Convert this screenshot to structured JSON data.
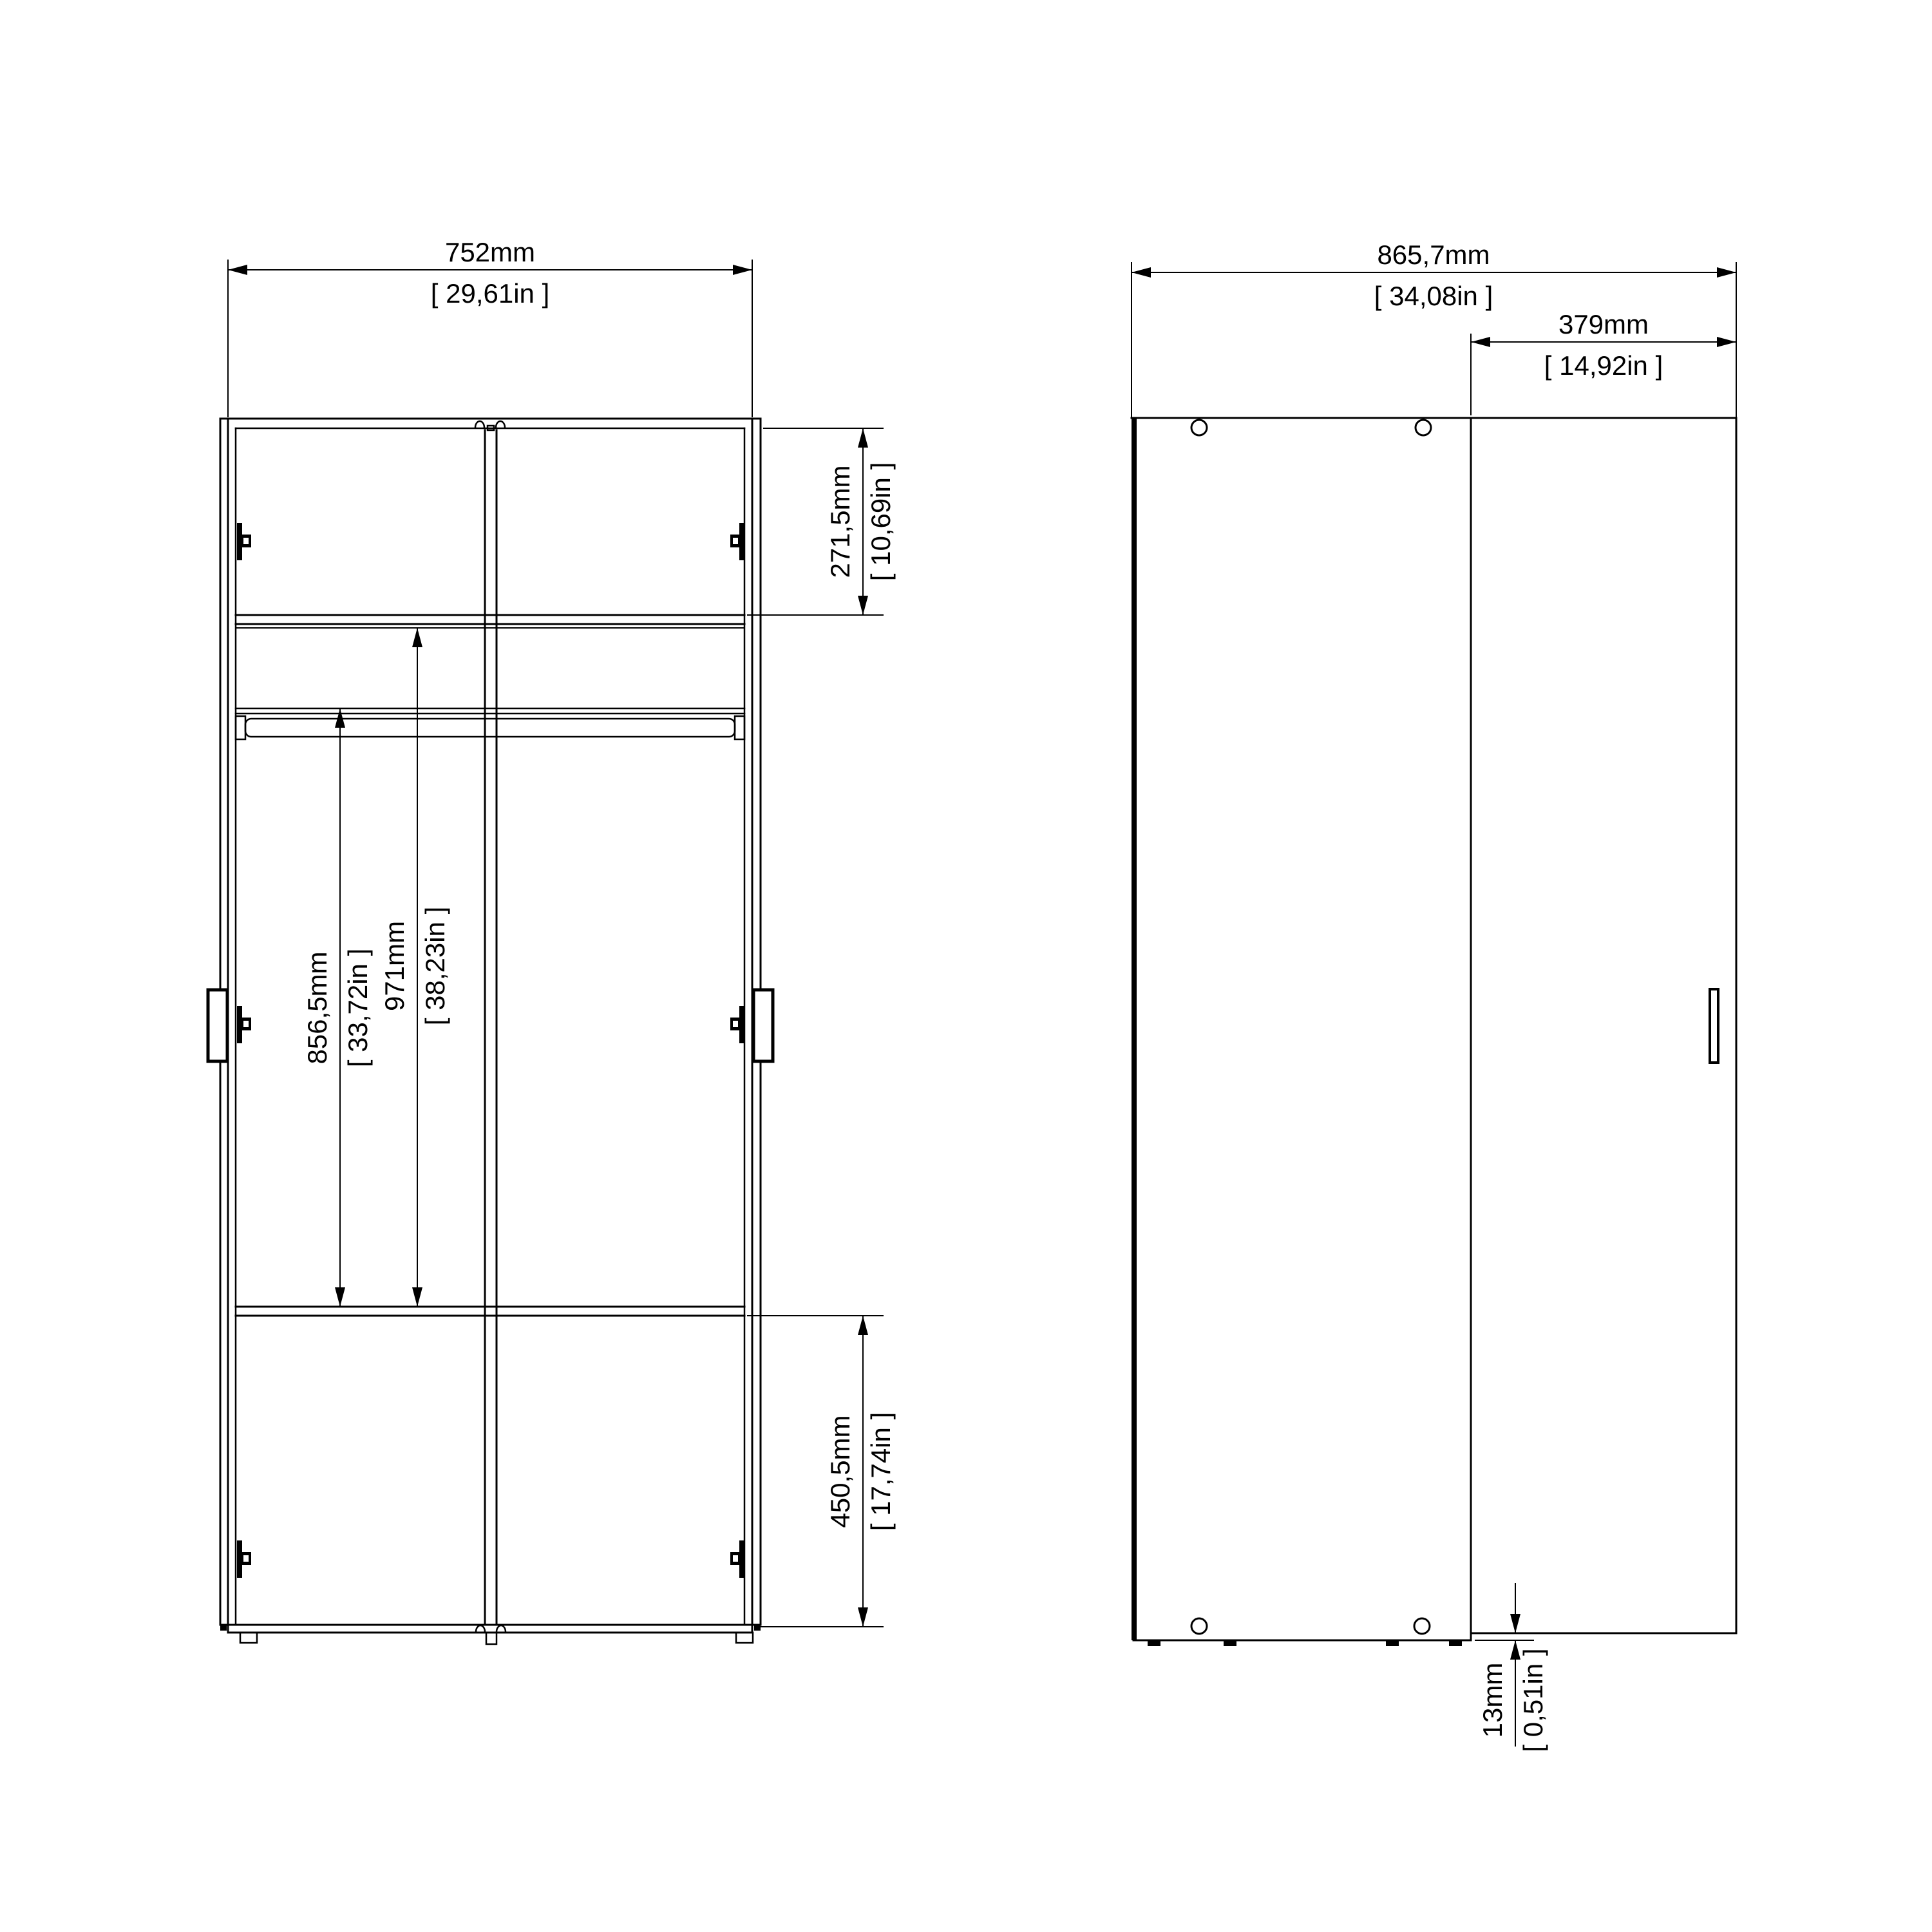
{
  "colors": {
    "line": "#000000",
    "background": "#ffffff"
  },
  "dims": {
    "front_width": {
      "mm": "752mm",
      "in": "[ 29,61in ]"
    },
    "front_top_section": {
      "mm": "271,5mm",
      "in": "[ 10,69in ]"
    },
    "front_rail_height": {
      "mm": "856,5mm",
      "in": "[ 33,72in ]"
    },
    "front_interior_height": {
      "mm": "971mm",
      "in": "[ 38,23in ]"
    },
    "front_bottom_section": {
      "mm": "450,5mm",
      "in": "[ 17,74in ]"
    },
    "side_width": {
      "mm": "865,7mm",
      "in": "[ 34,08in ]"
    },
    "side_door_width": {
      "mm": "379mm",
      "in": "[ 14,92in ]"
    },
    "side_base_gap": {
      "mm": "13mm",
      "in": "[ 0,51in ]"
    }
  }
}
